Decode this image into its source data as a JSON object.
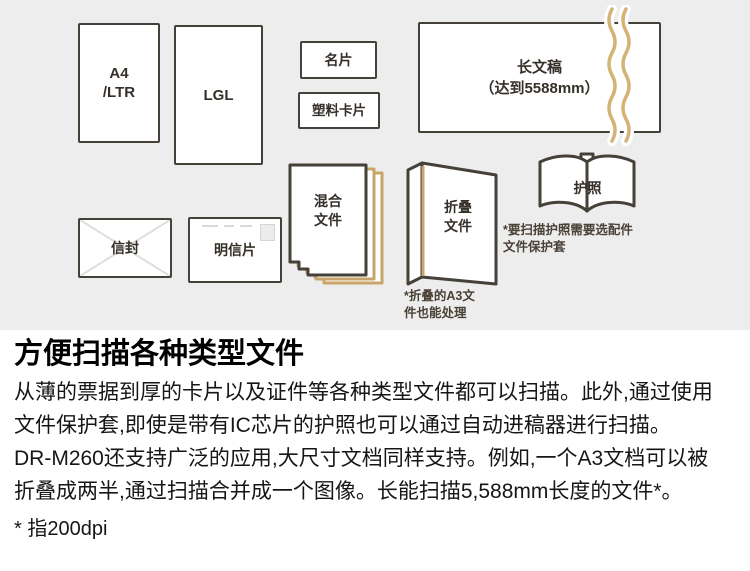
{
  "diagram": {
    "a4_label": [
      "A4",
      "/LTR"
    ],
    "lgl_label": "LGL",
    "business_card_label": "名片",
    "plastic_card_label": "塑料卡片",
    "long_doc_label": [
      "长文稿",
      "（达到5588mm）"
    ],
    "mixed_label": [
      "混合",
      "文件"
    ],
    "folded_label": [
      "折叠",
      "文件"
    ],
    "folded_note": [
      "*折叠的A3文",
      "件也能处理"
    ],
    "passport_label": "护照",
    "passport_note": [
      "*要扫描护照需要选配件",
      "文件保护套"
    ],
    "envelope_label": "信封",
    "postcard_label": "明信片"
  },
  "content": {
    "heading": "方便扫描各种类型文件",
    "body_lines": [
      "从薄的票据到厚的卡片以及证件等各种类型文件都可以扫描。此外,通过使用",
      "文件保护套,即使是带有IC芯片的护照也可以通过自动进稿器进行扫描。",
      "DR-M260还支持广泛的应用,大尺寸文档同样支持。例如,一个A3文档可以被",
      "折叠成两半,通过扫描合并成一个图像。长能扫描5,588mm长度的文件*。"
    ],
    "footnote": "* 指200dpi"
  },
  "colors": {
    "diagram_bg": "#ededed",
    "shape_border": "#454038",
    "accent_tan": "#c9a56b",
    "wave_tan": "#d4b377",
    "label_text": "#35302a",
    "note_text": "#4a4137",
    "body_text": "#161616"
  }
}
